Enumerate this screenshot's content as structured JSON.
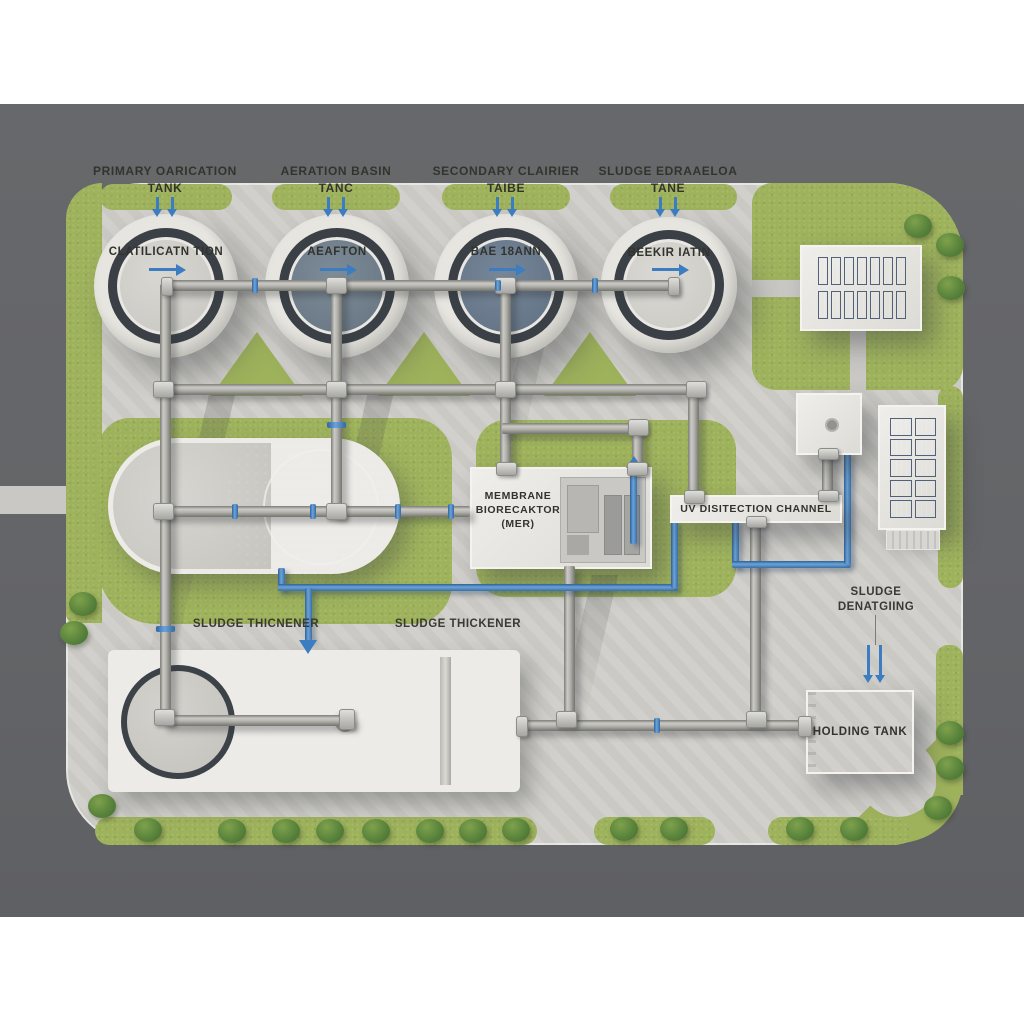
{
  "scene_title": "Wastewater treatment plant aerial schematic",
  "top_labels": [
    {
      "line1": "PRIMARY OARICATION",
      "line2": "TANK"
    },
    {
      "line1": "AERATION BASIN",
      "line2": "TANC"
    },
    {
      "line1": "SECONDARY CLAIRIER",
      "line2": "TAIBE"
    },
    {
      "line1": "SLUDGE EDRAAELOA",
      "line2": "TANE"
    }
  ],
  "tanks": [
    {
      "label": "CLATILICATN TION"
    },
    {
      "label": "AEAFTON"
    },
    {
      "label": "BAE 18ANN"
    },
    {
      "label": "BEEKIR IATIN"
    }
  ],
  "mbr": {
    "line1": "MEMBRANE",
    "line2": "BIORECAKTOR",
    "line3": "(MER)"
  },
  "uv": {
    "label": "UV DISITECTION CHANNEL"
  },
  "thickener_left": "SLUDGE THICNENER",
  "thickener_right": "SLUDGE THICKENER",
  "dewatering": {
    "line1": "SLUDGE",
    "line2": "DENATGIING"
  },
  "holding_tank": "HOLDING TANK",
  "colors": {
    "grass": "#9eb25c",
    "water": "#5e6f7e",
    "concrete": "#cfcec9",
    "road": "#646568",
    "pipe_gray": "#a8a7a3",
    "flow_blue": "#3f7fc1",
    "solar_panel": "#2c3848"
  }
}
